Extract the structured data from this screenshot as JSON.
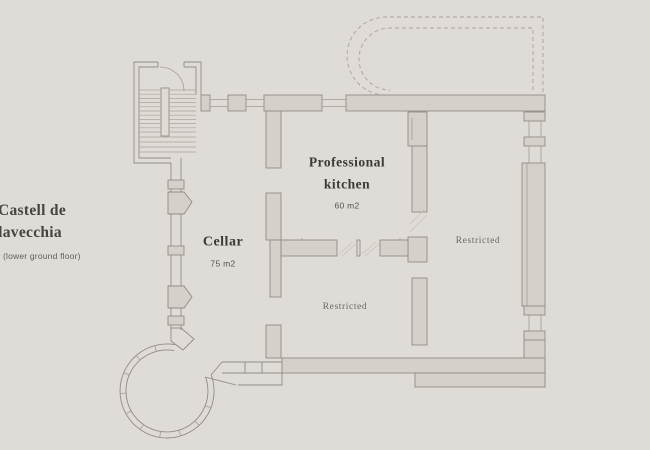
{
  "title_block": {
    "name_line1": "Castell de",
    "name_line2": "Villavecchia",
    "subtitle": "Cellar (lower ground floor)"
  },
  "floor_plan": {
    "rooms": {
      "kitchen": {
        "label_line1": "Professional",
        "label_line2": "kitchen",
        "area": "60 m2"
      },
      "cellar": {
        "label": "Cellar",
        "area": "75 m2"
      },
      "restricted_right": {
        "label": "Restricted"
      },
      "restricted_lower": {
        "label": "Restricted"
      }
    },
    "colors": {
      "background": "#dfdbd6",
      "wall_fill": "#d5d0ca",
      "wall_line": "#918c85",
      "dashed_outline": "#a8a29a",
      "title_text": "#454440",
      "room_title_text": "#3b3a38",
      "muted_text": "#6b6862"
    }
  }
}
